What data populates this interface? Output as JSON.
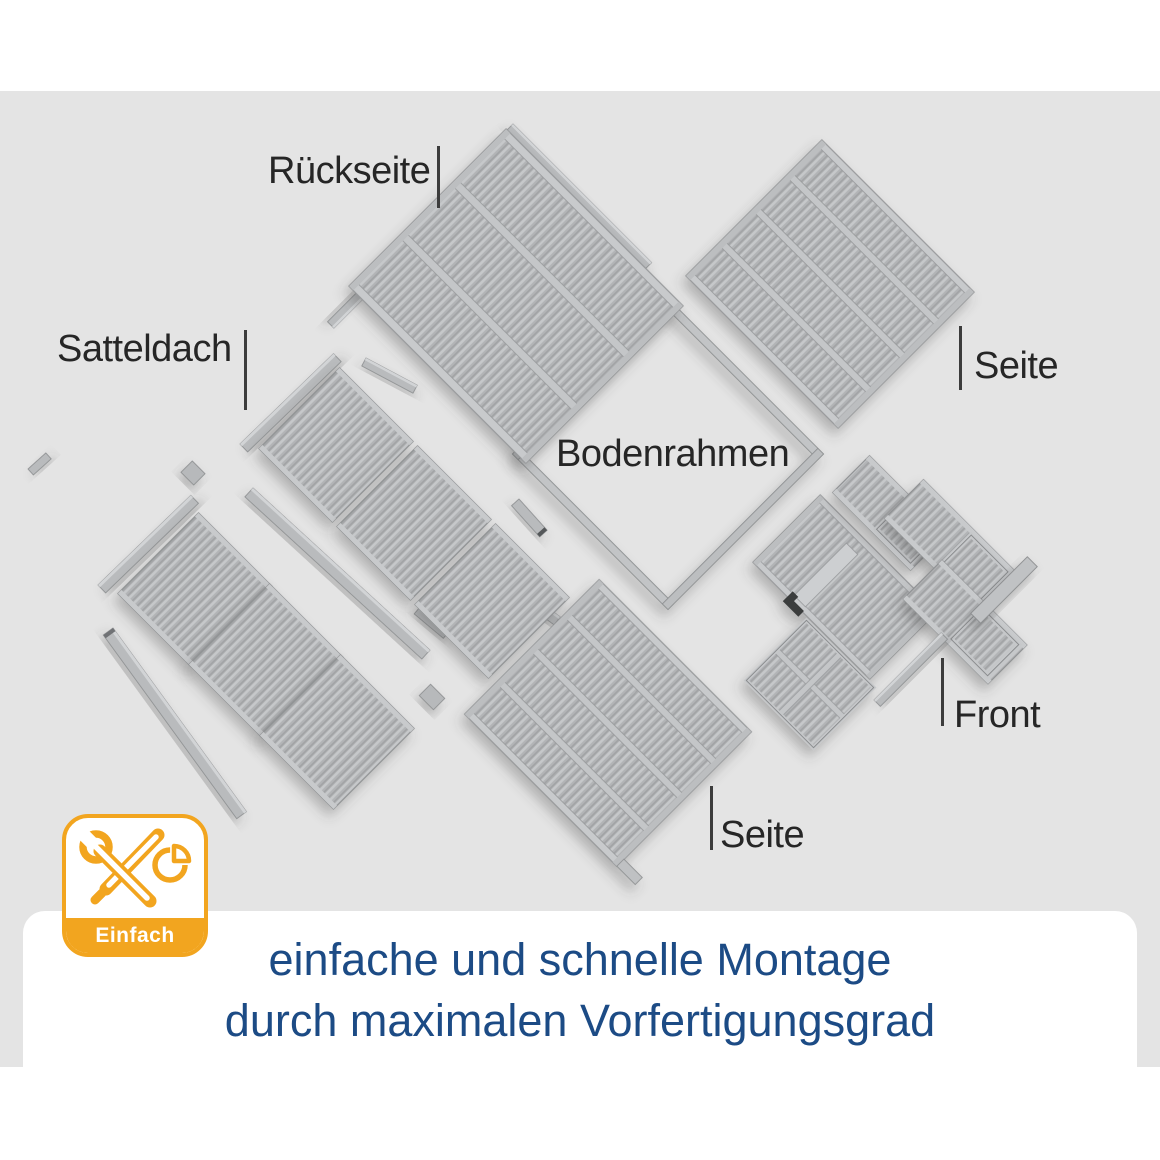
{
  "diagram": {
    "labels": {
      "rueckseite": "Rückseite",
      "satteldach": "Satteldach",
      "seite_right": "Seite",
      "bodenrahmen": "Bodenrahmen",
      "front": "Front",
      "seite_bottom": "Seite"
    }
  },
  "badge": {
    "label": "Einfach",
    "icons": [
      "wrench-and-screwdriver-icon",
      "pie-chart-icon"
    ],
    "accent_color": "#F2A51F"
  },
  "caption": {
    "line1": "einfache und schnelle Montage",
    "line2": "durch maximalen Vorfertigungsgrad",
    "text_color": "#1C4B85"
  },
  "colors": {
    "background_gray": "#E4E4E4",
    "panel_gray": "#B3B5B7",
    "label_text": "#262626"
  }
}
